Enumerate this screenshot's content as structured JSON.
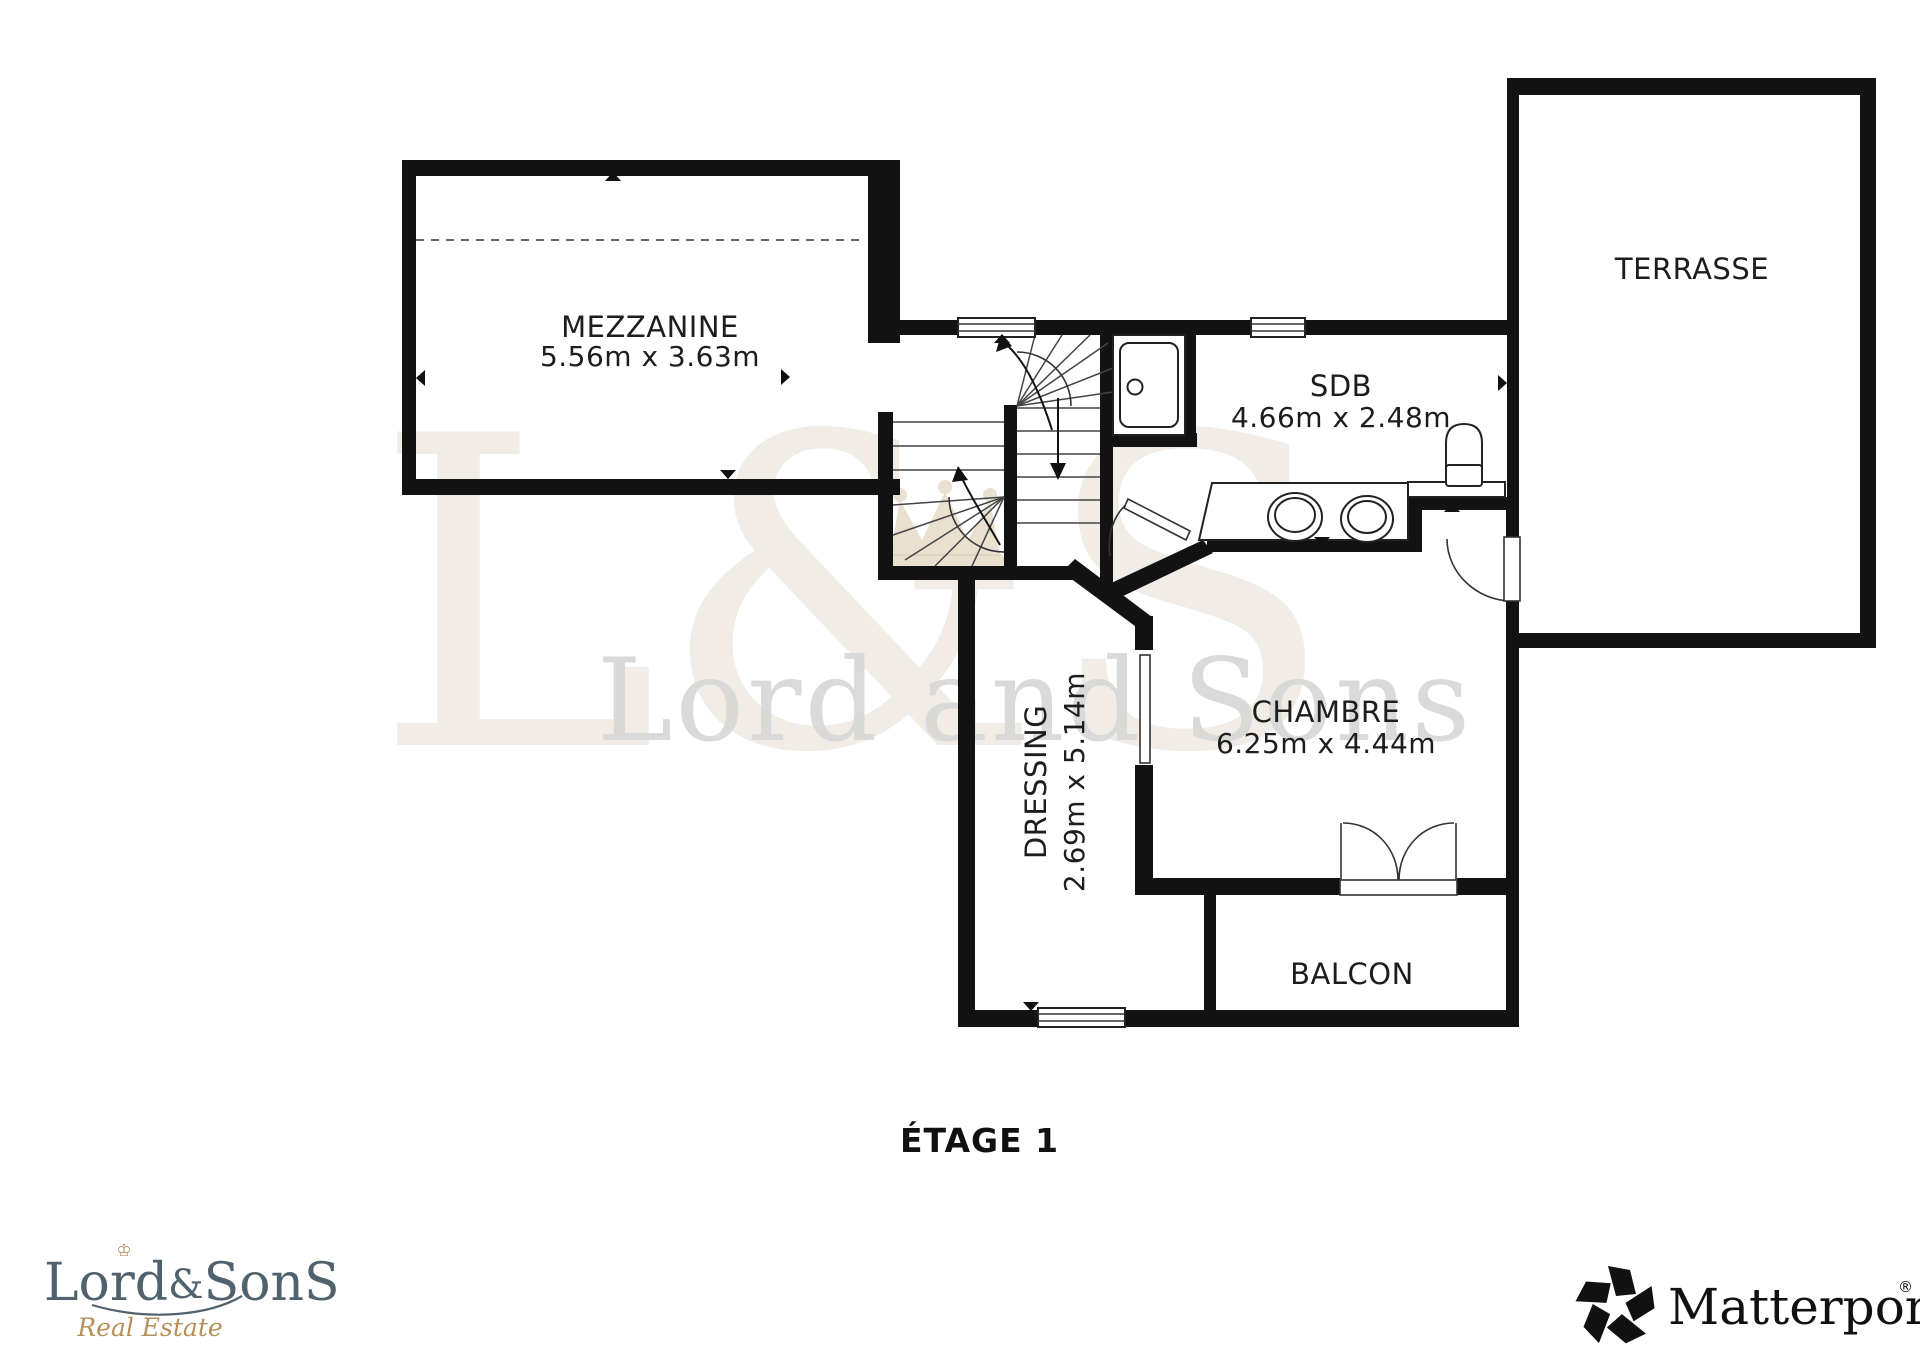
{
  "floor_plan": {
    "floor_label": "ÉTAGE 1",
    "rooms": [
      {
        "id": "mezzanine",
        "name": "MEZZANINE",
        "dimensions": "5.56m x 3.63m"
      },
      {
        "id": "terrasse",
        "name": "TERRASSE",
        "dimensions": ""
      },
      {
        "id": "sdb",
        "name": "SDB",
        "dimensions": "4.66m x 2.48m"
      },
      {
        "id": "chambre",
        "name": "CHAMBRE",
        "dimensions": "6.25m x 4.44m"
      },
      {
        "id": "dressing",
        "name": "DRESSING",
        "dimensions": "2.69m x 5.14m"
      },
      {
        "id": "balcon",
        "name": "BALCON",
        "dimensions": ""
      }
    ],
    "wall_color": "#121212"
  },
  "watermark": {
    "monogram": "L&S",
    "name": "Lord and Sons",
    "monogram_color": "#cfc2ab",
    "crown_color": "#dbcdb2",
    "text_color": "#d6d6d6"
  },
  "branding": {
    "agency": {
      "wordmark_parts": {
        "lord": "Lord",
        "ampersand": "&",
        "sons": "SonS"
      },
      "crown_glyph": "♔",
      "tagline": "Real Estate",
      "primary_color": "#51626f",
      "gold_color": "#b6905a"
    },
    "provider": {
      "name": "Matterport",
      "registered_mark": "®",
      "color": "#111111"
    }
  }
}
